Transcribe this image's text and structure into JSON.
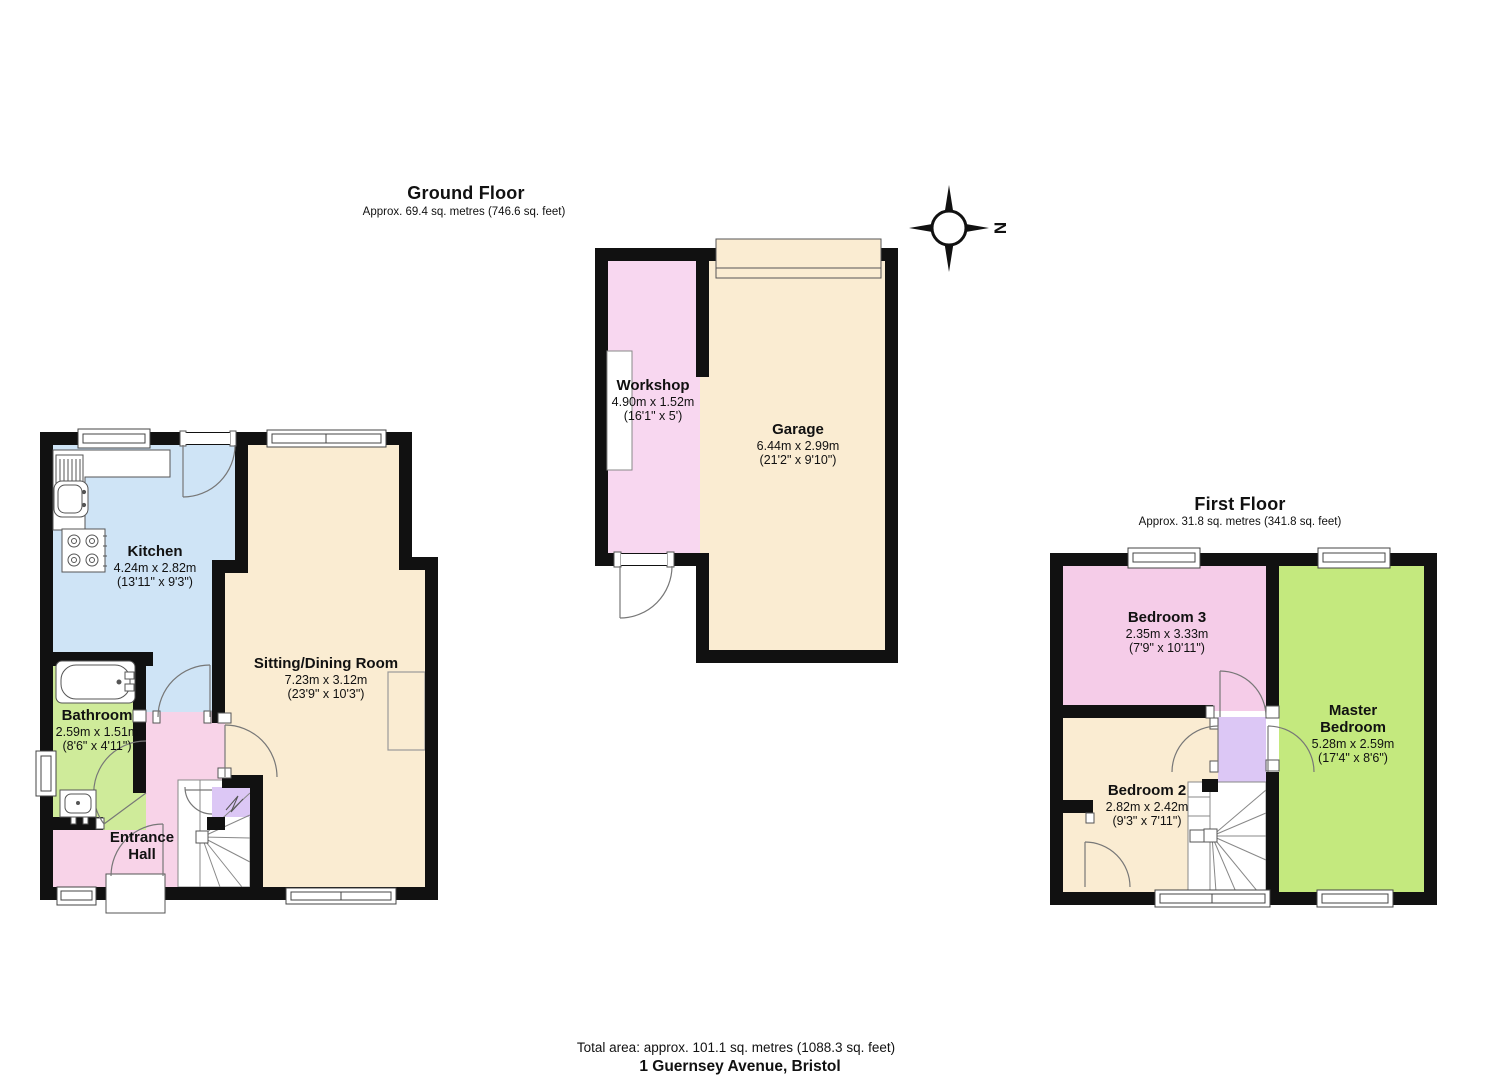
{
  "ground_floor": {
    "title": "Ground Floor",
    "subtitle": "Approx. 69.4 sq. metres (746.6 sq. feet)"
  },
  "first_floor": {
    "title": "First Floor",
    "subtitle": "Approx. 31.8 sq. metres (341.8 sq. feet)"
  },
  "footer": {
    "total_area": "Total area: approx. 101.1 sq. metres (1088.3 sq. feet)",
    "address": "1 Guernsey Avenue, Bristol"
  },
  "compass": {
    "label": "N"
  },
  "colors": {
    "wall": "#111111",
    "arc": "#777777",
    "fixture_stroke": "#555555"
  },
  "rooms": {
    "kitchen": {
      "name": "Kitchen",
      "metric": "4.24m x 2.82m",
      "imperial": "(13'11\" x 9'3\")",
      "color": "#cfe4f6"
    },
    "sitting": {
      "name": "Sitting/Dining Room",
      "metric": "7.23m x 3.12m",
      "imperial": "(23'9\" x 10'3\")",
      "color": "#faecd2"
    },
    "bathroom": {
      "name": "Bathroom",
      "metric": "2.59m x 1.51m",
      "imperial": "(8'6\" x 4'11\")",
      "color": "#cfeb9a"
    },
    "hall": {
      "name": "Entrance Hall",
      "color": "#f8d3e8"
    },
    "workshop": {
      "name": "Workshop",
      "metric": "4.90m x 1.52m",
      "imperial": "(16'1\" x 5')",
      "color": "#f8d7f0"
    },
    "garage": {
      "name": "Garage",
      "metric": "6.44m x 2.99m",
      "imperial": "(21'2\" x 9'10\")",
      "color": "#faecd2"
    },
    "bedroom3": {
      "name": "Bedroom 3",
      "metric": "2.35m x 3.33m",
      "imperial": "(7'9\" x 10'11\")",
      "color": "#f5cce8"
    },
    "master": {
      "name": "Master Bedroom",
      "metric": "5.28m x 2.59m",
      "imperial": "(17'4\" x 8'6\")",
      "color": "#c4e97e"
    },
    "bedroom2": {
      "name": "Bedroom 2",
      "metric": "2.82m x 2.42m",
      "imperial": "(9'3\" x 7'11\")",
      "color": "#faecd2"
    },
    "landing": {
      "color": "#dcc7f5"
    }
  }
}
